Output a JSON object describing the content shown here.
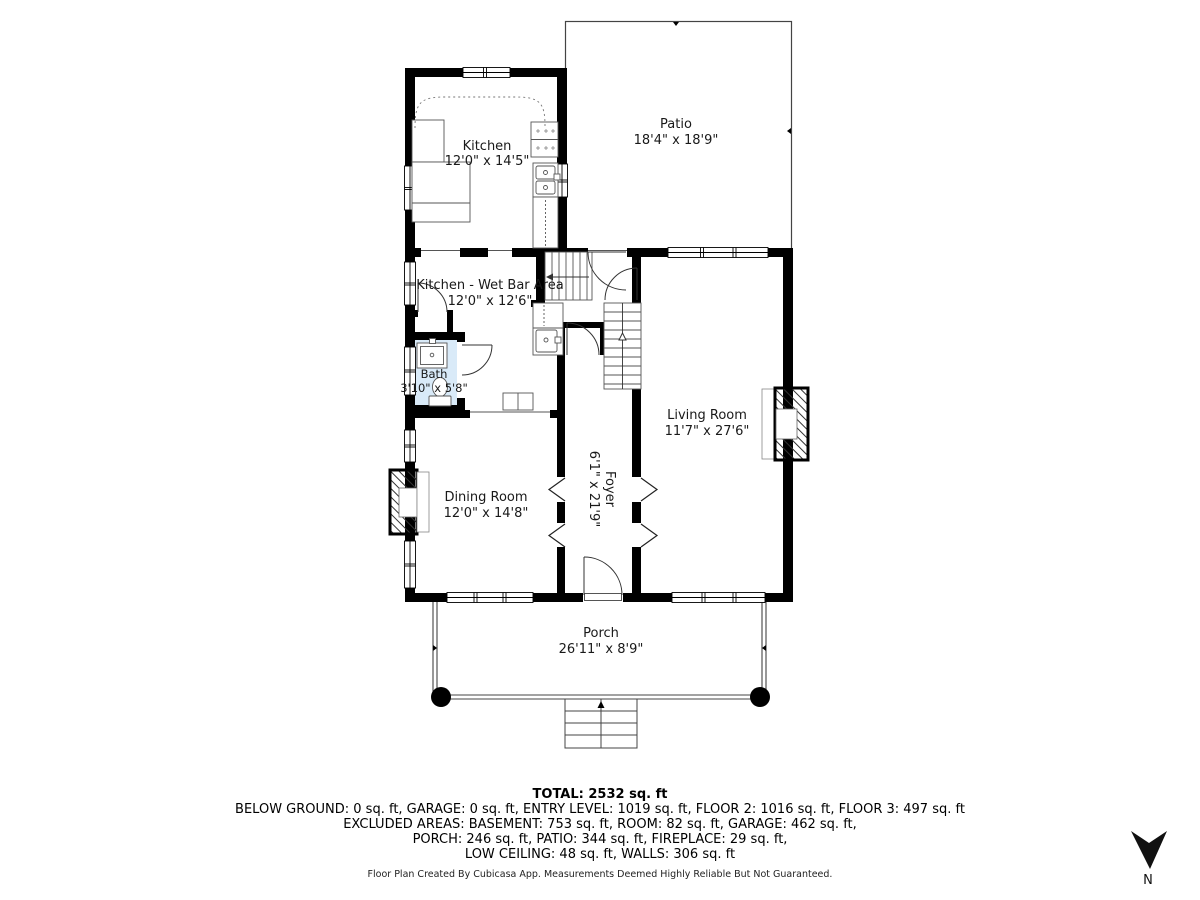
{
  "rooms": {
    "kitchen": {
      "name": "Kitchen",
      "dims": "12'0\" x 14'5\""
    },
    "patio": {
      "name": "Patio",
      "dims": "18'4\" x 18'9\""
    },
    "wet_bar": {
      "name": "Kitchen - Wet Bar Area",
      "dims": "12'0\" x 12'6\""
    },
    "bath": {
      "name": "Bath",
      "dims": "3'10\" x 5'8\""
    },
    "living_room": {
      "name": "Living Room",
      "dims": "11'7\" x 27'6\""
    },
    "dining_room": {
      "name": "Dining Room",
      "dims": "12'0\" x 14'8\""
    },
    "foyer": {
      "name": "Foyer",
      "dims": "6'1\" x 21'9\""
    },
    "porch": {
      "name": "Porch",
      "dims": "26'11\" x 8'9\""
    }
  },
  "title_block": {
    "total": "TOTAL: 2532 sq. ft",
    "lines": [
      "BELOW GROUND: 0 sq. ft, GARAGE: 0 sq. ft, ENTRY LEVEL: 1019 sq. ft, FLOOR 2: 1016 sq. ft, FLOOR 3: 497 sq. ft",
      "EXCLUDED AREAS: BASEMENT: 753 sq. ft, ROOM: 82 sq. ft, GARAGE: 462 sq. ft,",
      "PORCH: 246 sq. ft, PATIO: 344 sq. ft, FIREPLACE: 29 sq. ft,",
      "LOW CEILING: 48 sq. ft, WALLS: 306 sq. ft"
    ],
    "disclaimer": "Floor Plan Created By Cubicasa App. Measurements Deemed Highly Reliable But Not Guaranteed."
  },
  "compass": {
    "north_label": "N"
  },
  "colors": {
    "wall": "#000000",
    "bath_fill": "#d9eaf8",
    "outline": "#444444",
    "text": "#191919"
  }
}
